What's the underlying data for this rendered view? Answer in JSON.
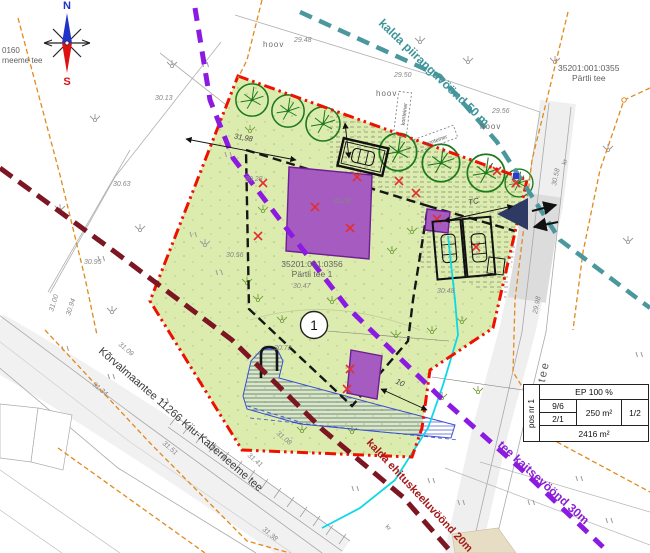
{
  "compass": {
    "north": "N",
    "south": "S"
  },
  "zone_labels": {
    "kalda_piiranguvoond": "kalda piiranguvöönd 50 m",
    "tee_kaitsevoond": "tee kaitsevöönd 30m",
    "kalda_ehituskeeluvoond": "kalda ehituskeeluvöönd 20m"
  },
  "roads": {
    "korvalmaantee": "Kõrvalmaantee 11266 Kiiu-Kaberneeme tee",
    "partli_tee": "Pärtli tee"
  },
  "parcels": {
    "neighbor_code": "35201:001:0355",
    "neighbor_name": "Pärtli tee",
    "plot_code": "35201:001:0356",
    "plot_name": "Pärtli tee 1",
    "west_code_fragment": "0160",
    "west_name_fragment": "rneeme tee"
  },
  "site_labels": {
    "hoov": "hoov",
    "konteiner": "konteiner",
    "kr": "kr",
    "pos_number": "1"
  },
  "dimensions": {
    "edge_length": "31,98",
    "envelope_offset": "10",
    "parking_tc": "TC"
  },
  "elevations": [
    {
      "t": "30.13"
    },
    {
      "t": "30.63"
    },
    {
      "t": "29.48"
    },
    {
      "t": "29.50"
    },
    {
      "t": "29.56"
    },
    {
      "t": "30.95"
    },
    {
      "t": "30.28"
    },
    {
      "t": "30.26"
    },
    {
      "t": "30.56"
    },
    {
      "t": "30.47"
    },
    {
      "t": "30.48"
    },
    {
      "t": "30.72"
    },
    {
      "t": "31.09"
    },
    {
      "t": "31.34"
    },
    {
      "t": "31.51"
    },
    {
      "t": "31.75"
    },
    {
      "t": "31.41"
    },
    {
      "t": "31.38"
    },
    {
      "t": "31.08"
    },
    {
      "t": "30.94"
    },
    {
      "t": "31.00"
    },
    {
      "t": "30.58"
    },
    {
      "t": "29.98"
    }
  ],
  "ep_table": {
    "pos": "pos nr 1",
    "ep": "EP 100 %",
    "v1": "9/6",
    "v2": "2/1",
    "area": "250 m²",
    "ratio": "1/2",
    "total": "2416 m²"
  },
  "colors": {
    "plot_fill": "#dcecae",
    "boundary_red": "#ee1100",
    "building_purple": "#a55bc0",
    "zone_teal": "#4a989e",
    "zone_violet": "#8b1be0",
    "zone_darkred": "#7c1622",
    "cadastral_orange": "#e08a1e",
    "utility_cyan": "#0cd8e8"
  }
}
